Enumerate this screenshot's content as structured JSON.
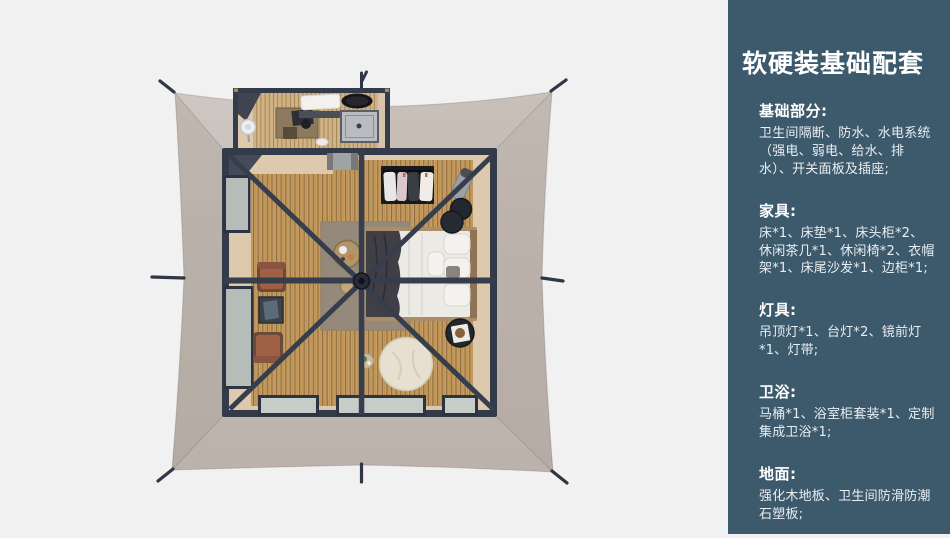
{
  "panel": {
    "title": "软硬装基础配套",
    "bg_color": "#3d5a6d",
    "text_color": "#ffffff",
    "sections": [
      {
        "heading": "基础部分:",
        "body": "卫生间隔断、防水、水电系统（强电、弱电、给水、排水）、开关面板及插座;"
      },
      {
        "heading": "家具:",
        "body": "床*1、床垫*1、床头柜*2、休闲茶几*1、休闲椅*2、衣帽架*1、床尾沙发*1、边柜*1;"
      },
      {
        "heading": "灯具:",
        "body": "吊顶灯*1、台灯*2、镜前灯*1、灯带;"
      },
      {
        "heading": "卫浴:",
        "body": "马桶*1、浴室柜套装*1、定制集成卫浴*1;"
      },
      {
        "heading": "地面:",
        "body": "强化木地板、卫生间防滑防潮石塑板;"
      }
    ]
  },
  "illustration": {
    "name": "tent-suite-top-view-render",
    "colors": {
      "background": "#f1f1f2",
      "canopy": "#c2b9b2",
      "frame": "#343b4b",
      "wood_floor": "#c79e60",
      "deck_border": "#dcc9ae",
      "bedding": "#eceae5",
      "chair": "#a06046",
      "rug": "#95897b"
    }
  }
}
